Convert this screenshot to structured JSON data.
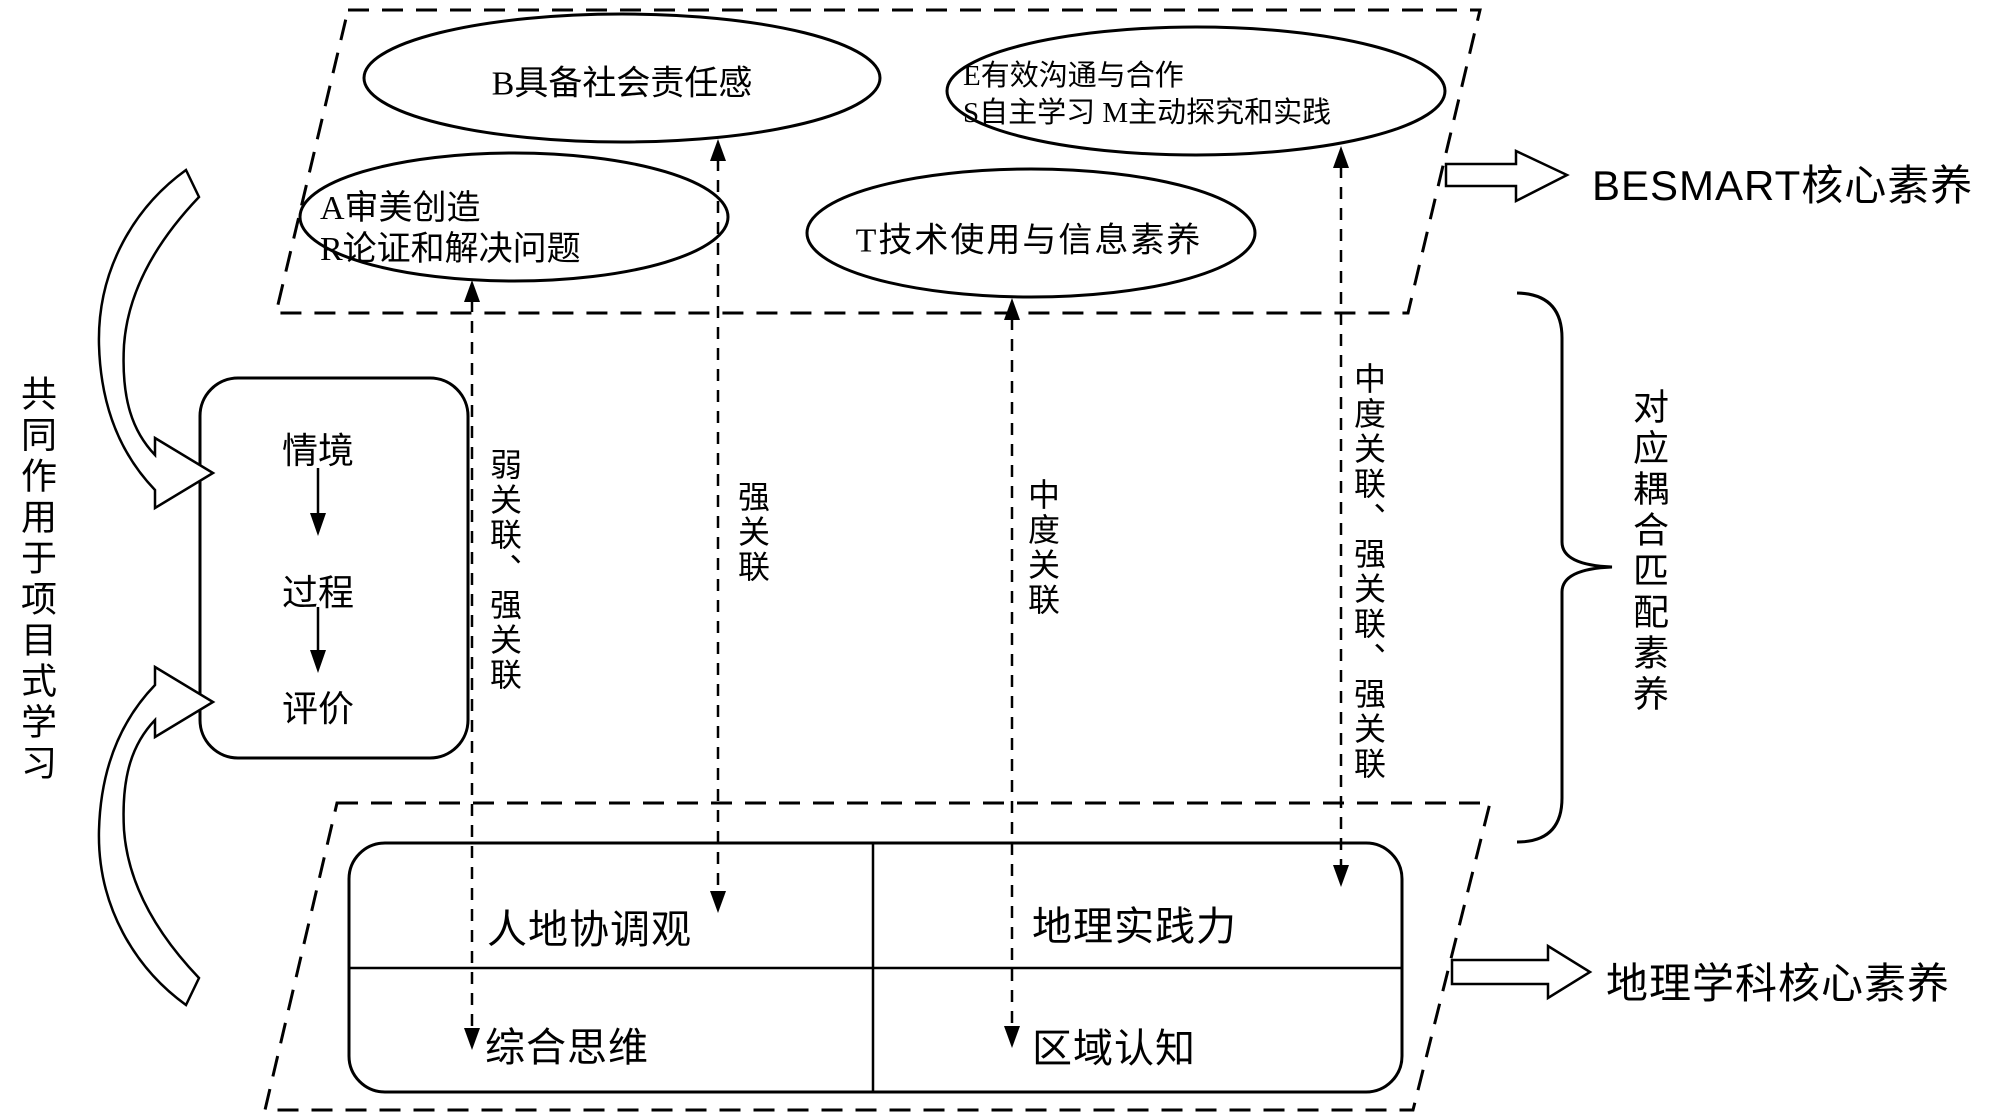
{
  "diagram": {
    "besmart_group": {
      "ellipse_b": "B具备社会责任感",
      "ellipse_ar_line1": "A审美创造",
      "ellipse_ar_line2": "R论证和解决问题",
      "ellipse_esm_line1": "E有效沟通与合作",
      "ellipse_esm_line2": "S自主学习 M主动探究和实践",
      "ellipse_t": "T技术使用与信息素养",
      "label": "BESMART核心素养"
    },
    "geo_group": {
      "cell_top_left": "人地协调观",
      "cell_top_right": "地理实践力",
      "cell_bottom_left": "综合思维",
      "cell_bottom_right": "区域认知",
      "label": "地理学科核心素养"
    },
    "process_box": {
      "items": [
        "情境",
        "过程",
        "评价"
      ]
    },
    "left_vertical_label": "共同作用于项目式学习",
    "coupling_label": "对应耦合匹配素养",
    "connectors": {
      "weak_strong": "弱关联、强关联",
      "strong": "强关联",
      "medium": "中度关联",
      "medium_strong_strong": "中度关联、强关联、强关联"
    },
    "colors": {
      "ink": "#000000",
      "background": "#ffffff"
    }
  }
}
